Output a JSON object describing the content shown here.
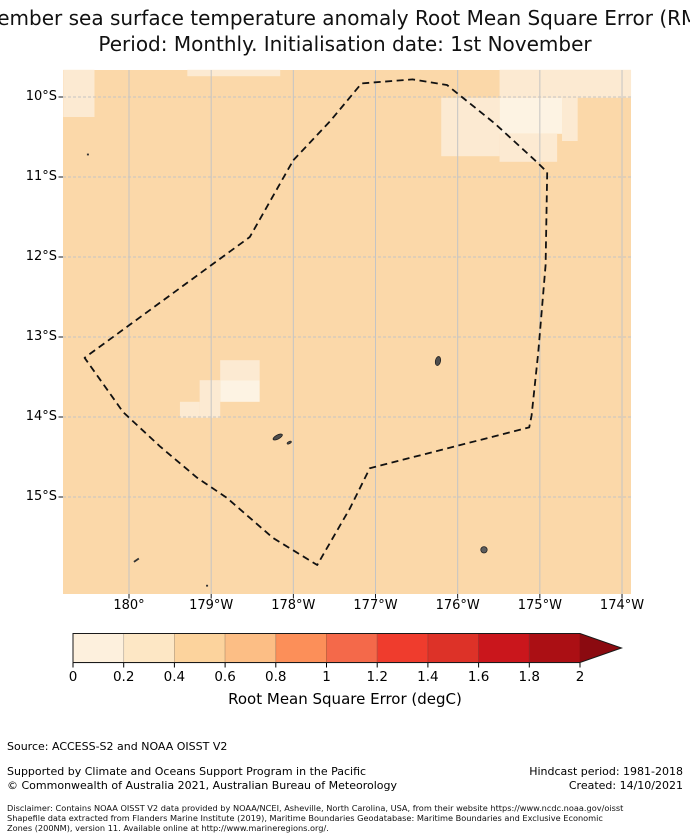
{
  "title": {
    "line1": "December sea surface temperature anomaly Root Mean Square Error (RMSE)",
    "line2": "Period: Monthly. Initialisation date: 1st November"
  },
  "chart_data": {
    "type": "heatmap",
    "title": "December sea surface temperature anomaly Root Mean Square Error (RMSE)",
    "subtitle": "Period: Monthly. Initialisation date: 1st November",
    "x_axis": {
      "labels": [
        "180°",
        "179°W",
        "178°W",
        "177°W",
        "176°W",
        "175°W",
        "174°W"
      ],
      "ticks_deg_west": [
        180,
        179,
        178,
        177,
        176,
        175,
        174
      ],
      "range_deg_west": [
        180.8,
        173.89
      ]
    },
    "y_axis": {
      "labels": [
        "10°S",
        "11°S",
        "12°S",
        "13°S",
        "14°S",
        "15°S"
      ],
      "ticks_deg_south": [
        10,
        11,
        12,
        13,
        14,
        15
      ],
      "range_deg_south": [
        9.66,
        16.21
      ]
    },
    "grid": true,
    "field_background_bin_degC": "0.4-0.6",
    "field_patches": [
      {
        "lon_w": [
          180.8,
          180.42
        ],
        "lat_s": [
          9.66,
          10.25
        ],
        "bin": "0.2-0.4"
      },
      {
        "lon_w": [
          179.29,
          178.16
        ],
        "lat_s": [
          9.66,
          9.74
        ],
        "bin": "0.2-0.4"
      },
      {
        "lon_w": [
          175.49,
          173.89
        ],
        "lat_s": [
          9.66,
          10.01
        ],
        "bin": "0.2-0.4"
      },
      {
        "lon_w": [
          175.49,
          174.73
        ],
        "lat_s": [
          10.01,
          10.46
        ],
        "bin": "0-0.2"
      },
      {
        "lon_w": [
          176.2,
          175.49
        ],
        "lat_s": [
          10.01,
          10.74
        ],
        "bin": "0.2-0.4"
      },
      {
        "lon_w": [
          175.49,
          174.79
        ],
        "lat_s": [
          10.46,
          10.81
        ],
        "bin": "0.2-0.4"
      },
      {
        "lon_w": [
          174.73,
          174.54
        ],
        "lat_s": [
          10.01,
          10.55
        ],
        "bin": "0.2-0.4"
      },
      {
        "lon_w": [
          178.89,
          178.41
        ],
        "lat_s": [
          13.29,
          13.54
        ],
        "bin": "0.2-0.4"
      },
      {
        "lon_w": [
          178.89,
          178.41
        ],
        "lat_s": [
          13.54,
          13.81
        ],
        "bin": "0-0.2"
      },
      {
        "lon_w": [
          179.14,
          178.89
        ],
        "lat_s": [
          13.54,
          14.01
        ],
        "bin": "0.2-0.4"
      },
      {
        "lon_w": [
          179.38,
          179.14
        ],
        "lat_s": [
          13.81,
          14.01
        ],
        "bin": "0.2-0.4"
      }
    ],
    "eez_boundary_deg": [
      [
        178.0,
        10.79
      ],
      [
        177.55,
        10.3
      ],
      [
        177.17,
        9.83
      ],
      [
        176.55,
        9.78
      ],
      [
        176.13,
        9.85
      ],
      [
        175.55,
        10.33
      ],
      [
        175.04,
        10.81
      ],
      [
        174.91,
        10.94
      ],
      [
        174.93,
        12.1
      ],
      [
        175.02,
        13.2
      ],
      [
        175.1,
        13.98
      ],
      [
        175.13,
        14.13
      ],
      [
        177.07,
        14.64
      ],
      [
        177.31,
        15.14
      ],
      [
        177.71,
        15.85
      ],
      [
        178.25,
        15.51
      ],
      [
        178.81,
        15.01
      ],
      [
        179.17,
        14.76
      ],
      [
        179.62,
        14.37
      ],
      [
        180.07,
        13.94
      ],
      [
        180.54,
        13.26
      ],
      [
        178.53,
        11.75
      ]
    ],
    "islands_deg": [
      {
        "lon_w": 176.24,
        "lat_s": 13.3,
        "shape": "blob-ns"
      },
      {
        "lon_w": 178.19,
        "lat_s": 14.25,
        "shape": "blob-ew"
      },
      {
        "lon_w": 178.05,
        "lat_s": 14.32,
        "shape": "islet"
      },
      {
        "lon_w": 175.68,
        "lat_s": 15.66,
        "shape": "dot"
      },
      {
        "lon_w": 179.91,
        "lat_s": 15.79,
        "shape": "dash"
      },
      {
        "lon_w": 180.5,
        "lat_s": 10.72,
        "shape": "speck"
      },
      {
        "lon_w": 179.05,
        "lat_s": 16.11,
        "shape": "speck"
      }
    ],
    "colorbar": {
      "label": "Root Mean Square Error (degC)",
      "tick_labels": [
        "0",
        "0.2",
        "0.4",
        "0.6",
        "0.8",
        "1",
        "1.2",
        "1.4",
        "1.6",
        "1.8",
        "2"
      ],
      "range_degC": [
        0,
        2
      ],
      "bin_step_degC": 0.2,
      "segment_colors": [
        "#fdf0dd",
        "#fde7c5",
        "#fcd39d",
        "#fcbe85",
        "#fc8f59",
        "#f4694a",
        "#ef3c2d",
        "#dd3228",
        "#ca161c",
        "#ab0f14"
      ],
      "extend_over_color": "#8b0a10"
    }
  },
  "colors": {
    "map_background": "#fbd8a9",
    "patch_00_02": "#fdf3e3",
    "patch_02_04": "#fcead2",
    "gridline": "#c4c4c4",
    "boundary": "#111111",
    "land": "#4d4d4d"
  },
  "footer": {
    "source": "Source: ACCESS-S2 and NOAA OISST V2",
    "supported": "Supported by Climate and Oceans Support Program in the Pacific",
    "copyright": "© Commonwealth of Australia 2021, Australian Bureau of Meteorology",
    "hindcast": "Hindcast period: 1981-2018",
    "created": "Created: 14/10/2021",
    "disclaimer_line1": "Disclaimer: Contains NOAA OISST V2 data provided by NOAA/NCEI, Asheville, North Carolina, USA, from their website https://www.ncdc.noaa.gov/oisst",
    "disclaimer_line2": "Shapefile data extracted from Flanders Marine Institute (2019), Maritime Boundaries Geodatabase: Maritime Boundaries and Exclusive Economic",
    "disclaimer_line3": "Zones (200NM), version 11. Available online at http://www.marineregions.org/."
  }
}
